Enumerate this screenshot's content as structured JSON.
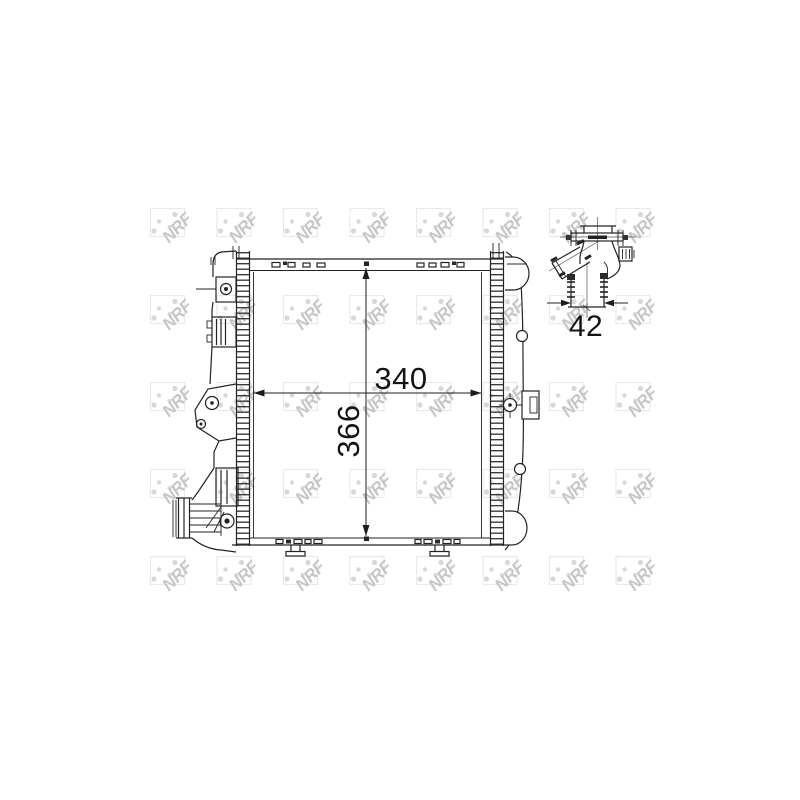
{
  "figure": {
    "type": "technical-drawing",
    "brand_watermark": "NRF",
    "views": {
      "front": {
        "width_label": "340",
        "height_label": "366"
      },
      "fitting_detail": {
        "diameter_label": "42"
      }
    }
  },
  "colors": {
    "background": "#ffffff",
    "line": "#222222",
    "dimension_text": "#141414",
    "watermark_letters": "#c6c6c4",
    "watermark_box": "#e9e9e7",
    "watermark_dots": "#d8d8d6"
  }
}
